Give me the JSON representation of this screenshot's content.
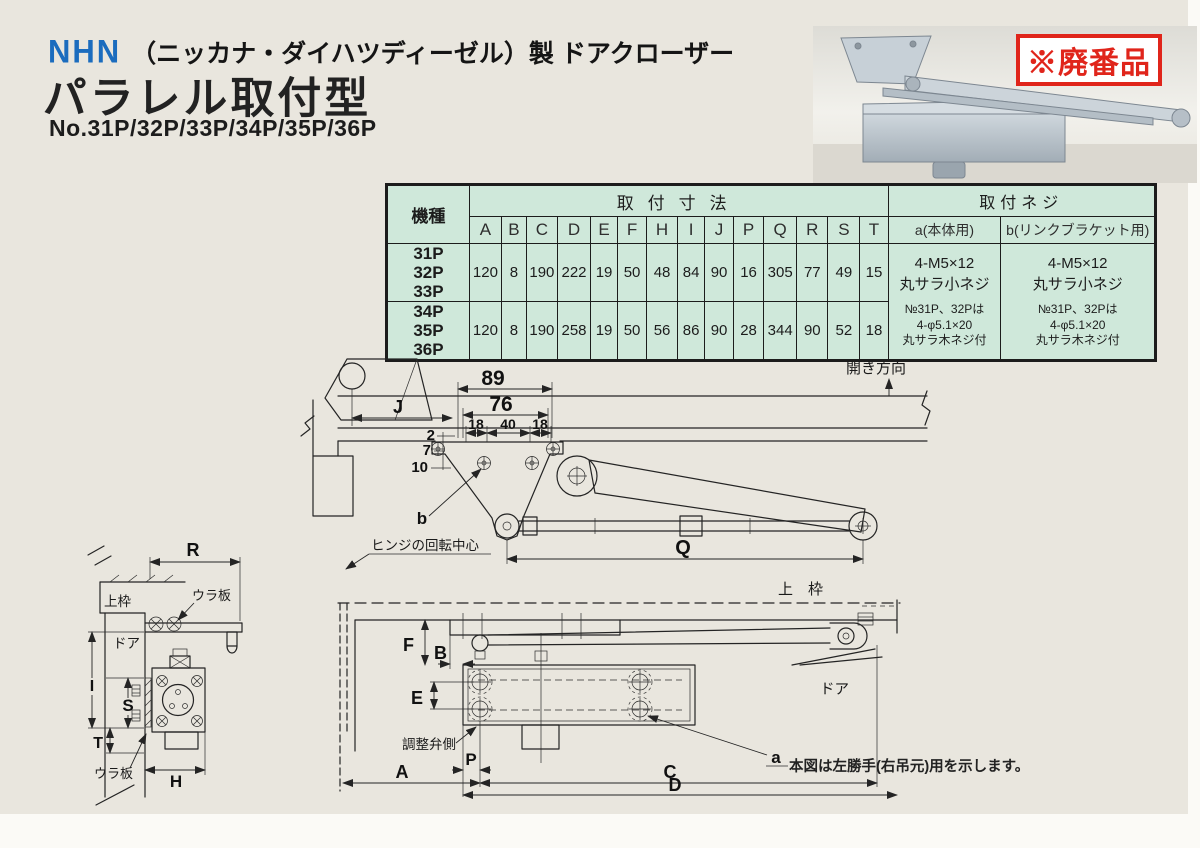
{
  "colors": {
    "page_bg": "#e9e6de",
    "table_bg": "#cfe8da",
    "logo_blue": "#1b6cbe",
    "badge_red": "#e0251b",
    "line": "#242424"
  },
  "header": {
    "logo": "NHN",
    "maker_line": "（ニッカナ・ダイハツディーゼル）製 ドアクローザー",
    "title": "パラレル取付型",
    "models_line": "No.31P/32P/33P/34P/35P/36P",
    "badge": "※廃番品"
  },
  "spec_table": {
    "model_header": "機種",
    "dims_header": "取付寸法",
    "screws_header": "取付ネジ",
    "dim_columns": [
      "A",
      "B",
      "C",
      "D",
      "E",
      "F",
      "H",
      "I",
      "J",
      "P",
      "Q",
      "R",
      "S",
      "T"
    ],
    "screw_col_a": "a(本体用)",
    "screw_col_b": "b(リンクブラケット用)",
    "rows": [
      {
        "models": [
          "31P",
          "32P",
          "33P"
        ],
        "values": [
          "120",
          "8",
          "190",
          "222",
          "19",
          "50",
          "48",
          "84",
          "90",
          "16",
          "305",
          "77",
          "49",
          "15"
        ]
      },
      {
        "models": [
          "34P",
          "35P",
          "36P"
        ],
        "values": [
          "120",
          "8",
          "190",
          "258",
          "19",
          "50",
          "56",
          "86",
          "90",
          "28",
          "344",
          "90",
          "52",
          "18"
        ]
      }
    ],
    "screw_note": {
      "size": "4-M5×12",
      "type": "丸サラ小ネジ",
      "cond": "№31P、32Pは",
      "size2": "4-φ5.1×20",
      "type2": "丸サラ木ネジ付"
    }
  },
  "plan_view": {
    "dim_89": "89",
    "dim_76": "76",
    "dim_18l": "18",
    "dim_40": "40",
    "dim_18r": "18",
    "dim_j": "J",
    "dim_2": "2",
    "dim_7": "7",
    "dim_10": "10",
    "label_b": "b",
    "dim_q": "Q",
    "hinge_center": "ヒンジの回転中心",
    "open_dir": "開き方向"
  },
  "side_view": {
    "dim_r": "R",
    "top_frame": "上枠",
    "back_plate_top": "ウラ板",
    "door": "ドア",
    "dim_i": "I",
    "dim_s": "S",
    "dim_t": "T",
    "dim_h": "H",
    "back_plate_bottom": "ウラ板"
  },
  "front_view": {
    "top_frame": "上　枠",
    "dim_f": "F",
    "dim_b": "B",
    "dim_e": "E",
    "adjust_valve": "調整弁側",
    "dim_p": "P",
    "dim_a": "A",
    "dim_c": "C",
    "dim_d": "D",
    "label_a": "a",
    "door": "ドア",
    "note": "本図は左勝手(右吊元)用を示します。"
  }
}
